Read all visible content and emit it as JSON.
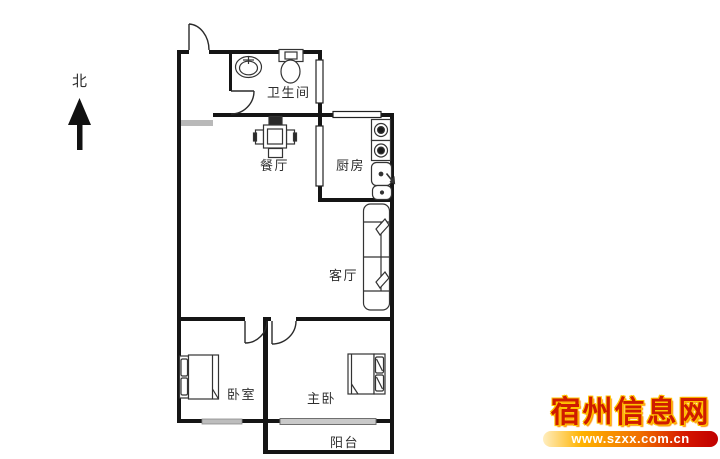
{
  "north": {
    "label": "北"
  },
  "rooms": [
    {
      "name": "bathroom",
      "label": "卫生间"
    },
    {
      "name": "dining-room",
      "label": "餐厅"
    },
    {
      "name": "kitchen",
      "label": "厨房"
    },
    {
      "name": "living-room",
      "label": "客厅"
    },
    {
      "name": "bedroom",
      "label": "卧室"
    },
    {
      "name": "master-bedroom",
      "label": "主卧"
    },
    {
      "name": "balcony",
      "label": "阳台"
    }
  ],
  "fixtures": [
    "entry-door",
    "bathroom-door",
    "bedroom-door",
    "master-bedroom-door",
    "wash-basin",
    "toilet",
    "dining-table-with-chairs",
    "gas-stove-two-burners",
    "kitchen-sink",
    "sofa",
    "double-bed",
    "double-bed",
    "window",
    "sliding-door",
    "north-arrow"
  ],
  "watermark": {
    "site_name": "宿州信息网",
    "url": "www.szxx.com.cn"
  },
  "colors": {
    "wall": "#151515",
    "furniture_stroke": "#333333",
    "window_gray": "#bdbdbd",
    "watermark_red": "#cf1b00",
    "watermark_glow": "#ffc400",
    "url_bar_orange": "#f07000"
  }
}
